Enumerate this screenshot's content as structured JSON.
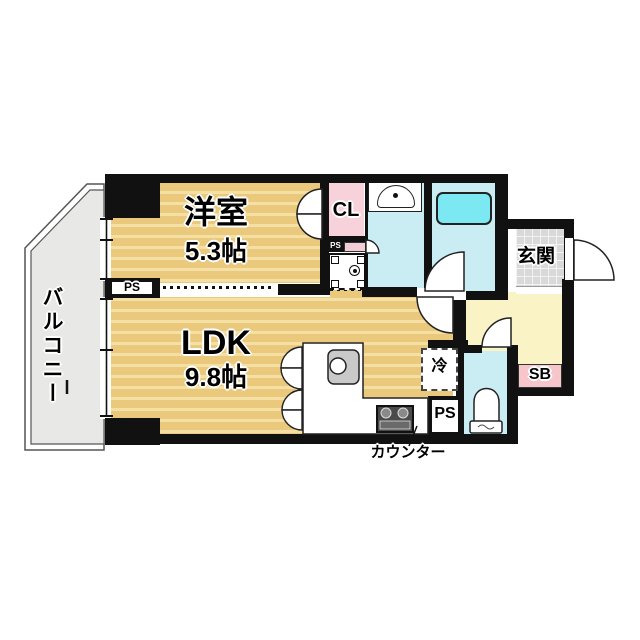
{
  "floorplan": {
    "balcony": {
      "label": "バルコニー"
    },
    "western_room": {
      "label": "洋室",
      "area": "5.3帖"
    },
    "ldk": {
      "label": "LDK",
      "area": "9.8帖"
    },
    "closet": {
      "label": "CL"
    },
    "entrance": {
      "label": "玄関"
    },
    "shoebox": {
      "label": "SB"
    },
    "refrigerator": {
      "label": "冷"
    },
    "counter_note": {
      "label": "カウンター"
    },
    "pipe_space_wall": {
      "label": "PS"
    },
    "pipe_space_kitchen": {
      "label": "PS"
    },
    "pipe_space_small": {
      "label": "PS"
    },
    "colors": {
      "wall": "#111111",
      "wood_floor": "#eac87c",
      "wood_floor_stripe": "#f4dfa4",
      "wet_area_floor": "#c9edf2",
      "bathtub": "#7ce8f2",
      "closet_pink": "#f8d2da",
      "shoebox_pink": "#f6c6cb",
      "hallway_yellow": "#faf3c6",
      "entrance_tile_gray": "#d9d9d9",
      "balcony_gray": "#e8e8e6"
    }
  }
}
